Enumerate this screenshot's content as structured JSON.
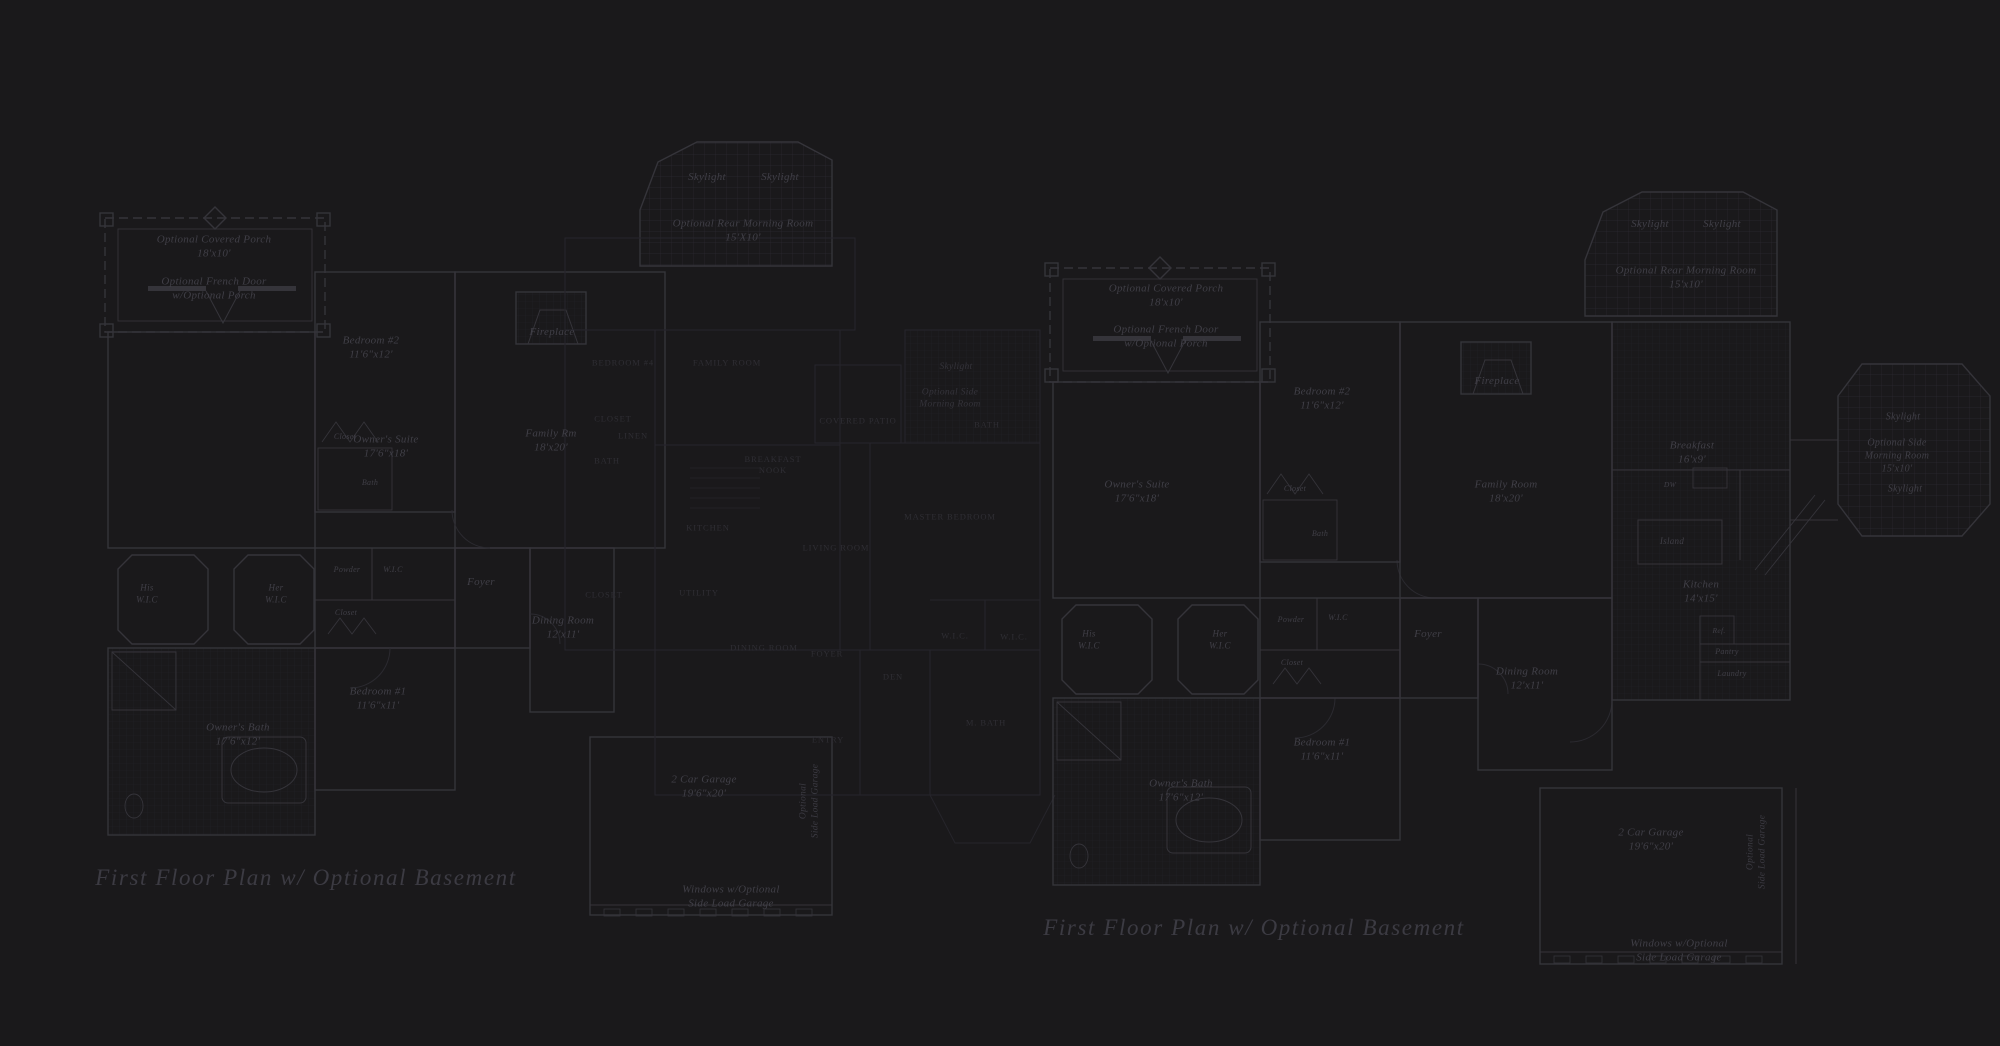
{
  "page": {
    "background": "#1a191b"
  },
  "colors": {
    "wall_bright": "#35343a",
    "wall_faint": "#26252b",
    "tile_hatch": "#222127",
    "grid_hatch": "#2a2930",
    "label_main": "#403f47",
    "label_overlay": "#2f2e34",
    "caption": "#3c3b43"
  },
  "plans": [
    {
      "name": "left-floor-plan",
      "caption": "First Floor Plan  w/ Optional Basement",
      "caption_x": 306,
      "caption_y": 878,
      "labels": [
        {
          "text": "Skylight",
          "x": 707,
          "y": 177
        },
        {
          "text": "Skylight",
          "x": 780,
          "y": 177
        },
        {
          "text": "Optional Rear Morning Room\n15'X10'",
          "x": 743,
          "y": 231
        },
        {
          "text": "Optional Covered Porch\n18'x10'",
          "x": 214,
          "y": 247
        },
        {
          "text": "Optional French Door\nw/Optional Porch",
          "x": 214,
          "y": 289
        },
        {
          "text": "Fireplace",
          "x": 552,
          "y": 332
        },
        {
          "text": "Bedroom #2\n11'6\"x12'",
          "x": 371,
          "y": 348
        },
        {
          "text": "Owner's Suite\n17'6\"x18'",
          "x": 386,
          "y": 447
        },
        {
          "text": "Family Rm\n18'x20'",
          "x": 551,
          "y": 441
        },
        {
          "text": "Closet",
          "x": 345,
          "y": 437,
          "size": 8
        },
        {
          "text": "Bath",
          "x": 370,
          "y": 483,
          "size": 8
        },
        {
          "text": "His\nW.I.C",
          "x": 147,
          "y": 594,
          "size": 9
        },
        {
          "text": "Her\nW.I.C",
          "x": 276,
          "y": 594,
          "size": 9
        },
        {
          "text": "Powder",
          "x": 347,
          "y": 570,
          "size": 8
        },
        {
          "text": "W.I.C",
          "x": 393,
          "y": 570,
          "size": 8
        },
        {
          "text": "Closet",
          "x": 346,
          "y": 613,
          "size": 8
        },
        {
          "text": "Foyer",
          "x": 481,
          "y": 582
        },
        {
          "text": "Dining Room\n12'x11'",
          "x": 563,
          "y": 628
        },
        {
          "text": "Bedroom #1\n11'6\"x11'",
          "x": 378,
          "y": 699
        },
        {
          "text": "Owner's Bath\n17'6\"x12'",
          "x": 238,
          "y": 735
        },
        {
          "text": "2 Car Garage\n19'6\"x20'",
          "x": 704,
          "y": 787
        },
        {
          "text": "Optional\nSide Load Garage",
          "x": 810,
          "y": 801,
          "style": "v"
        },
        {
          "text": "Windows w/Optional\nSide Load Garage",
          "x": 731,
          "y": 897
        },
        {
          "text": "Bedroom #4",
          "x": 623,
          "y": 363,
          "style": "c"
        },
        {
          "text": "Family Room",
          "x": 727,
          "y": 363,
          "style": "c"
        },
        {
          "text": "Closet",
          "x": 613,
          "y": 419,
          "style": "c"
        },
        {
          "text": "Linen",
          "x": 633,
          "y": 436,
          "style": "c"
        },
        {
          "text": "Bath",
          "x": 607,
          "y": 461,
          "style": "c"
        },
        {
          "text": "Breakfast\nNook",
          "x": 773,
          "y": 465,
          "style": "c"
        },
        {
          "text": "Kitchen",
          "x": 708,
          "y": 528,
          "style": "c"
        },
        {
          "text": "Living Room",
          "x": 836,
          "y": 548,
          "style": "c"
        },
        {
          "text": "Covered Patio",
          "x": 858,
          "y": 421,
          "style": "c"
        },
        {
          "text": "Bath",
          "x": 987,
          "y": 425,
          "style": "c"
        },
        {
          "text": "Master Bedroom",
          "x": 950,
          "y": 517,
          "style": "c"
        },
        {
          "text": "Closet",
          "x": 604,
          "y": 595,
          "style": "c"
        },
        {
          "text": "Utility",
          "x": 699,
          "y": 593,
          "style": "c"
        },
        {
          "text": "Dining Room",
          "x": 764,
          "y": 648,
          "style": "c"
        },
        {
          "text": "Foyer",
          "x": 827,
          "y": 654,
          "style": "c"
        },
        {
          "text": "Den",
          "x": 893,
          "y": 677,
          "style": "c"
        },
        {
          "text": "W.I.C.",
          "x": 955,
          "y": 636,
          "style": "c"
        },
        {
          "text": "W.I.C.",
          "x": 1014,
          "y": 637,
          "style": "c"
        },
        {
          "text": "M. Bath",
          "x": 986,
          "y": 723,
          "style": "c"
        },
        {
          "text": "Entry",
          "x": 828,
          "y": 740,
          "style": "c"
        },
        {
          "text": "Skylight",
          "x": 956,
          "y": 367,
          "style": "f"
        },
        {
          "text": "Optional Side\nMorning Room",
          "x": 950,
          "y": 399,
          "style": "f"
        }
      ]
    },
    {
      "name": "right-floor-plan",
      "caption": "First Floor Plan  w/ Optional Basement",
      "caption_x": 1254,
      "caption_y": 928,
      "labels": [
        {
          "text": "Skylight",
          "x": 1650,
          "y": 224
        },
        {
          "text": "Skylight",
          "x": 1722,
          "y": 224
        },
        {
          "text": "Optional Rear Morning Room\n15'x10'",
          "x": 1686,
          "y": 278
        },
        {
          "text": "Optional Covered Porch\n18'x10'",
          "x": 1166,
          "y": 296
        },
        {
          "text": "Optional French Door\nw/Optional Porch",
          "x": 1166,
          "y": 337
        },
        {
          "text": "Fireplace",
          "x": 1497,
          "y": 381
        },
        {
          "text": "Bedroom #2\n11'6\"x12'",
          "x": 1322,
          "y": 399
        },
        {
          "text": "Owner's Suite\n17'6\"x18'",
          "x": 1137,
          "y": 492
        },
        {
          "text": "Family Room\n18'x20'",
          "x": 1506,
          "y": 492
        },
        {
          "text": "Breakfast\n16'x9'",
          "x": 1692,
          "y": 453
        },
        {
          "text": "DW",
          "x": 1670,
          "y": 485,
          "size": 7.5
        },
        {
          "text": "Island",
          "x": 1672,
          "y": 542,
          "size": 9
        },
        {
          "text": "Kitchen\n14'x15'",
          "x": 1701,
          "y": 592
        },
        {
          "text": "Ref.",
          "x": 1719,
          "y": 631,
          "size": 7.5
        },
        {
          "text": "Pantry",
          "x": 1727,
          "y": 652,
          "size": 8
        },
        {
          "text": "Laundry",
          "x": 1732,
          "y": 674,
          "size": 8
        },
        {
          "text": "Skylight",
          "x": 1903,
          "y": 417,
          "size": 10
        },
        {
          "text": "Optional Side\nMorning Room\n15'x10'",
          "x": 1897,
          "y": 456,
          "size": 10
        },
        {
          "text": "Skylight",
          "x": 1905,
          "y": 489,
          "size": 10
        },
        {
          "text": "Closet",
          "x": 1295,
          "y": 489,
          "size": 8
        },
        {
          "text": "Bath",
          "x": 1320,
          "y": 534,
          "size": 8
        },
        {
          "text": "His\nW.I.C",
          "x": 1089,
          "y": 640,
          "size": 9
        },
        {
          "text": "Her\nW.I.C",
          "x": 1220,
          "y": 640,
          "size": 9
        },
        {
          "text": "Powder",
          "x": 1291,
          "y": 620,
          "size": 8
        },
        {
          "text": "W.I.C",
          "x": 1338,
          "y": 618,
          "size": 8
        },
        {
          "text": "Closet",
          "x": 1292,
          "y": 663,
          "size": 8
        },
        {
          "text": "Foyer",
          "x": 1428,
          "y": 634
        },
        {
          "text": "Dining Room\n12'x11'",
          "x": 1527,
          "y": 679
        },
        {
          "text": "Bedroom #1\n11'6\"x11'",
          "x": 1322,
          "y": 750
        },
        {
          "text": "Owner's Bath\n17'6\"x12'",
          "x": 1181,
          "y": 791
        },
        {
          "text": "2 Car Garage\n19'6\"x20'",
          "x": 1651,
          "y": 840
        },
        {
          "text": "Optional\nSide Load Garage",
          "x": 1757,
          "y": 852,
          "style": "v"
        },
        {
          "text": "Windows w/Optional\nSide Load Garage",
          "x": 1679,
          "y": 951
        }
      ]
    }
  ]
}
